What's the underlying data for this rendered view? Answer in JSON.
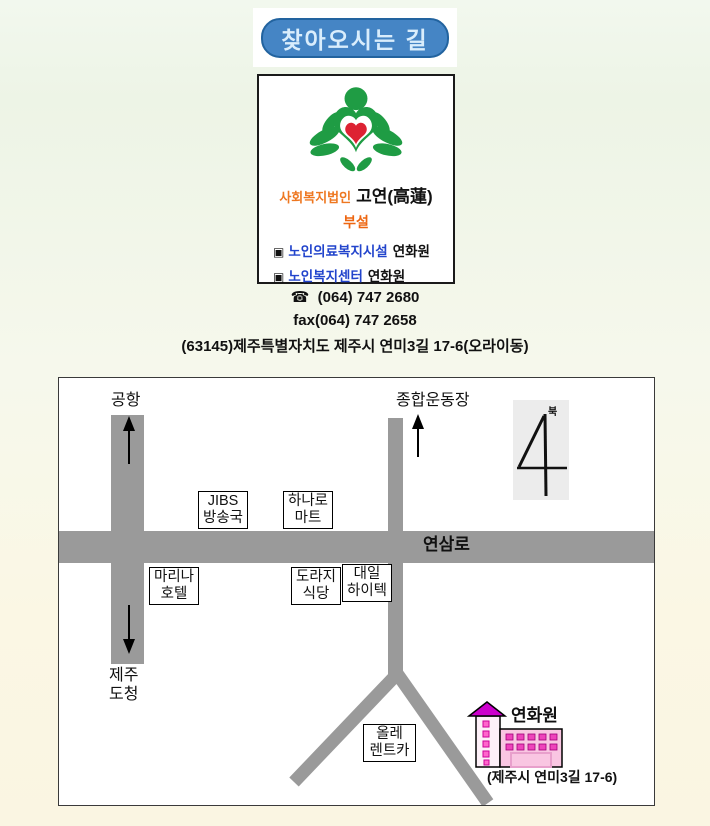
{
  "title_banner": {
    "label": "찾아오시는 길"
  },
  "org_card": {
    "org_type": "사회복지법인",
    "org_name": "고연(高蓮)",
    "subtitle": "부설",
    "facilities": [
      {
        "bullet": "▣",
        "type": "노인의료복지시설",
        "name": "연화원"
      },
      {
        "bullet": "▣",
        "type": "노인복지센터",
        "name": "연화원"
      }
    ],
    "colors": {
      "orange": "#ee7720",
      "blue": "#2244cc",
      "logo_green": "#1f9c44",
      "logo_red": "#dd2233"
    }
  },
  "contact": {
    "phone_icon": "☎",
    "phone": "(064) 747 2680",
    "fax": "fax(064) 747 2658",
    "address": "(63145)제주특별자치도 제주시 연미3길 17-6(오라이동)"
  },
  "map": {
    "road_color": "#9a9a9a",
    "road_label": "연삼로",
    "north_label": "북",
    "destinations": {
      "airport": "공항",
      "stadium": "종합운동장",
      "office_line1": "제주",
      "office_line2": "도청"
    },
    "landmarks": [
      {
        "line1": "JIBS",
        "line2": "방송국"
      },
      {
        "line1": "하나로",
        "line2": "마트"
      },
      {
        "line1": "마리나",
        "line2": "호텔"
      },
      {
        "line1": "도라지",
        "line2": "식당"
      },
      {
        "line1": "대일",
        "line2": "하이텍"
      },
      {
        "line1": "올레",
        "line2": "렌트카"
      }
    ],
    "destination_name": "연화원",
    "destination_address": "(제주시 연미3길 17-6)",
    "building_colors": {
      "pink": "#f9c6e2",
      "magenta": "#cc00cc",
      "window": "#ee44bb"
    }
  }
}
